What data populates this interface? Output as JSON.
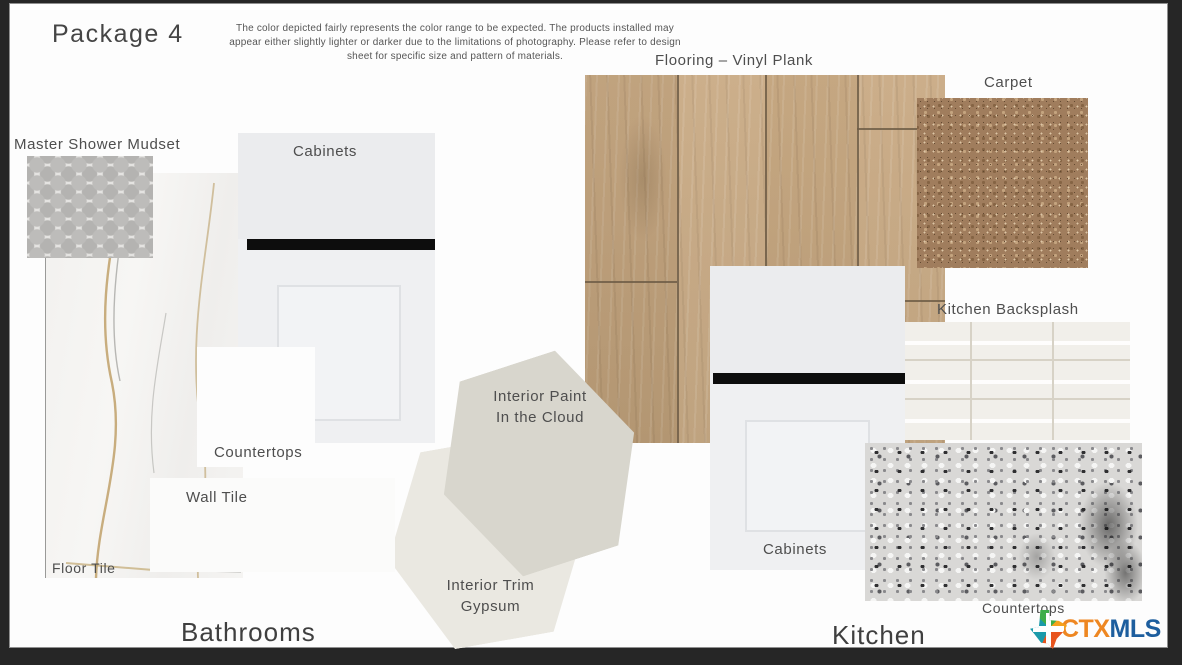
{
  "header": {
    "title": "Package 4",
    "disclaimer": "The color depicted fairly represents the color range to be expected.  The products installed may appear either slightly lighter or darker due to the limitations of photography. Please refer to design sheet for specific size and pattern of materials."
  },
  "bathrooms": {
    "section_label": "Bathrooms",
    "mudset_label": "Master Shower Mudset",
    "cabinets_label": "Cabinets",
    "countertops_label": "Countertops",
    "wall_tile_label": "Wall Tile",
    "floor_tile_label": "Floor Tile"
  },
  "paint": {
    "interior_paint_label": "Interior Paint",
    "interior_paint_color_name": "In the Cloud",
    "interior_paint_hex": "#d8d6cd",
    "interior_trim_label": "Interior Trim",
    "interior_trim_color_name": "Gypsum",
    "interior_trim_hex": "#eae8e1"
  },
  "kitchen": {
    "section_label": "Kitchen",
    "flooring_label": "Flooring – Vinyl Plank",
    "carpet_label": "Carpet",
    "backsplash_label": "Kitchen Backsplash",
    "cabinets_label": "Cabinets",
    "countertops_label": "Countertops"
  },
  "logo": {
    "ctx": "CTX",
    "mls": "MLS",
    "ctx_color": "#ee8722",
    "mls_color": "#1d5e9e"
  }
}
